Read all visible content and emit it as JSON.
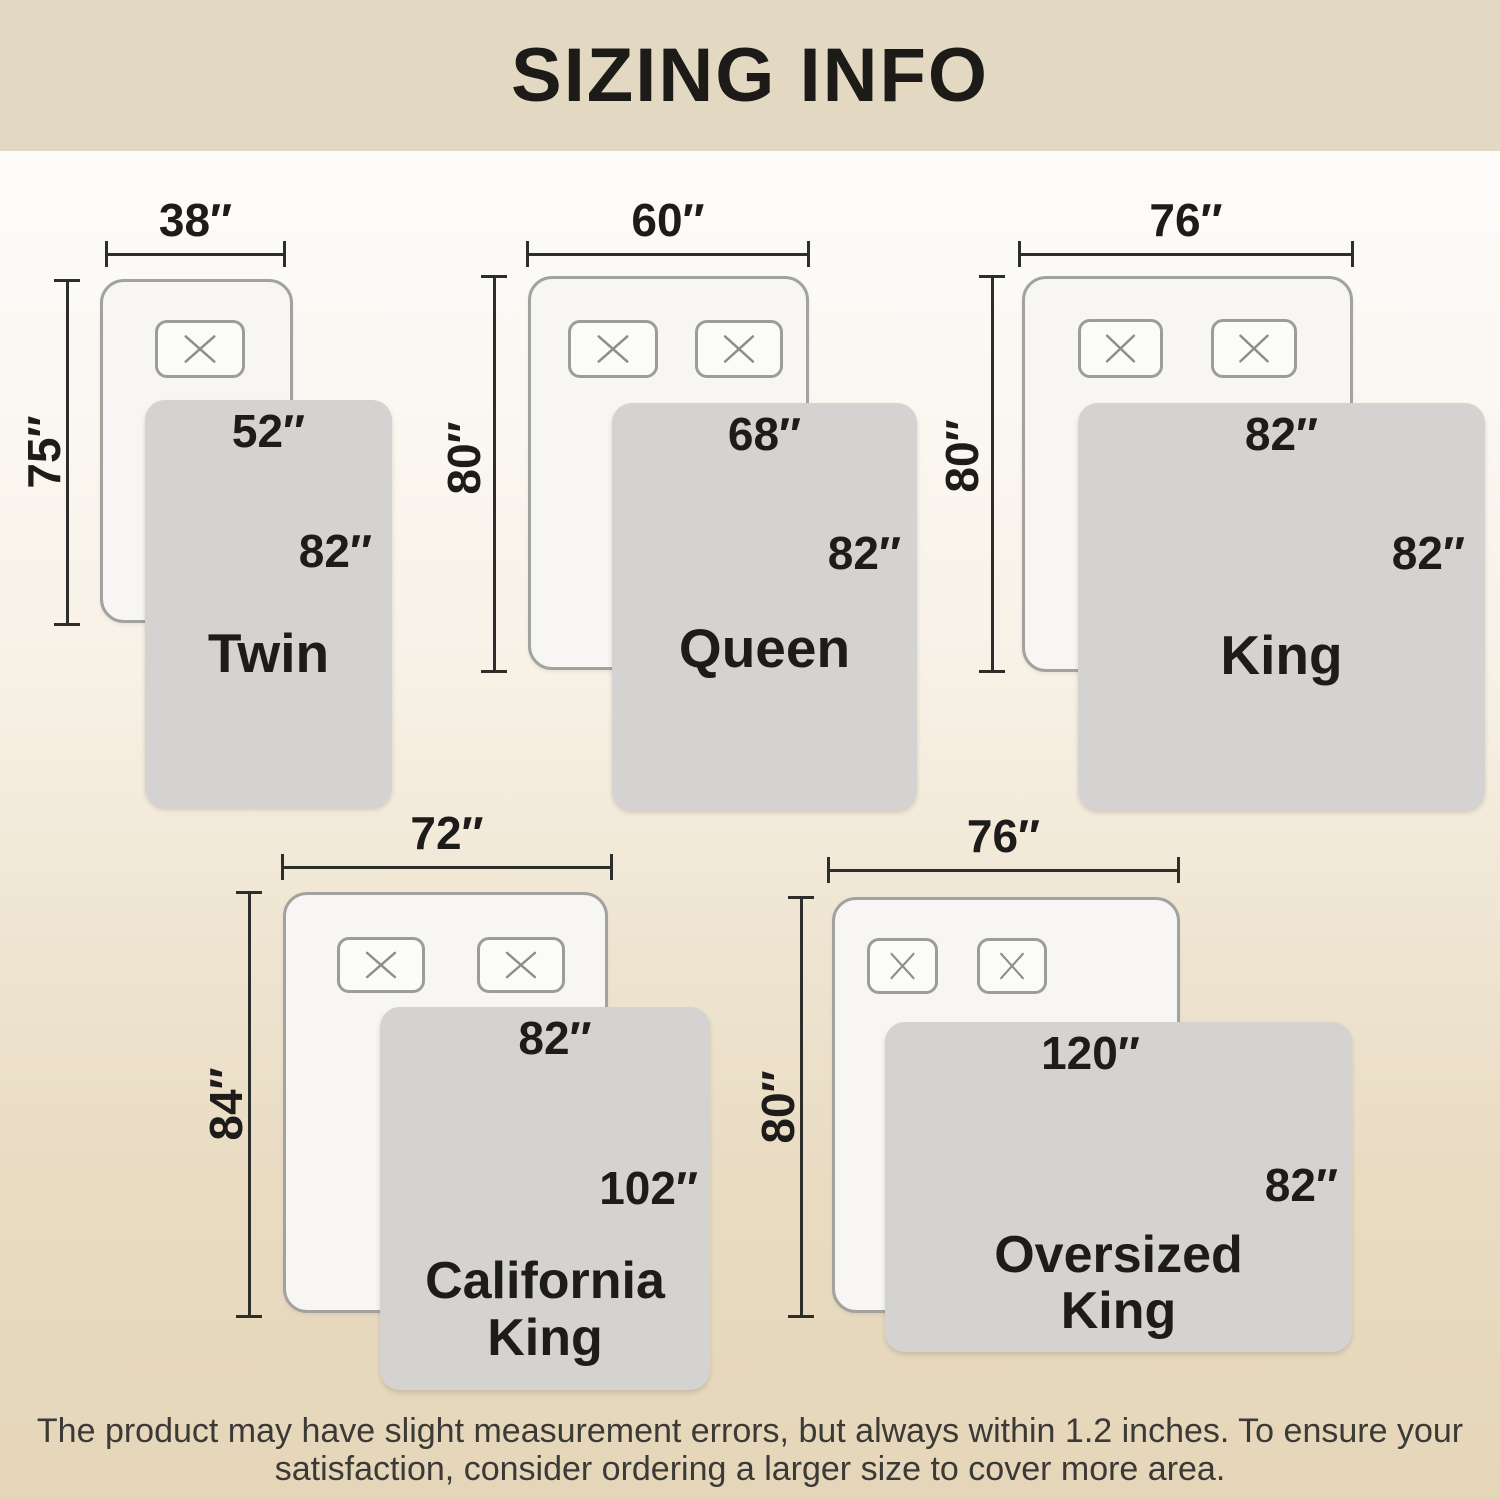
{
  "title": "SIZING INFO",
  "colors": {
    "band_background": "#e3d9c3",
    "page_bottom_background": "#e5d6b9",
    "blanket_fill": "#d4d3d1",
    "bed_fill": "#f7f6f4",
    "bed_border": "#a2a2a0",
    "dimension_line": "#2d2d2b",
    "label_text": "#1d1c1a"
  },
  "sizes": [
    {
      "name": "Twin",
      "name_lines": [
        "Twin"
      ],
      "bed_width": "38″",
      "bed_length": "75″",
      "blanket_width": "52″",
      "blanket_length": "82″",
      "pillow_count": 1
    },
    {
      "name": "Queen",
      "name_lines": [
        "Queen"
      ],
      "bed_width": "60″",
      "bed_length": "80″",
      "blanket_width": "68″",
      "blanket_length": "82″",
      "pillow_count": 2
    },
    {
      "name": "King",
      "name_lines": [
        "King"
      ],
      "bed_width": "76″",
      "bed_length": "80″",
      "blanket_width": "82″",
      "blanket_length": "82″",
      "pillow_count": 2
    },
    {
      "name": "California King",
      "name_lines": [
        "California",
        "King"
      ],
      "bed_width": "72″",
      "bed_length": "84″",
      "blanket_width": "82″",
      "blanket_length": "102″",
      "pillow_count": 2
    },
    {
      "name": "Oversized King",
      "name_lines": [
        "Oversized",
        "King"
      ],
      "bed_width": "76″",
      "bed_length": "80″",
      "blanket_width": "120″",
      "blanket_length": "82″",
      "pillow_count": 2
    }
  ],
  "footer": {
    "line1": "The product may have slight measurement errors, but always within 1.2 inches. To ensure your",
    "line2": "satisfaction, consider ordering a larger size to cover more area."
  }
}
